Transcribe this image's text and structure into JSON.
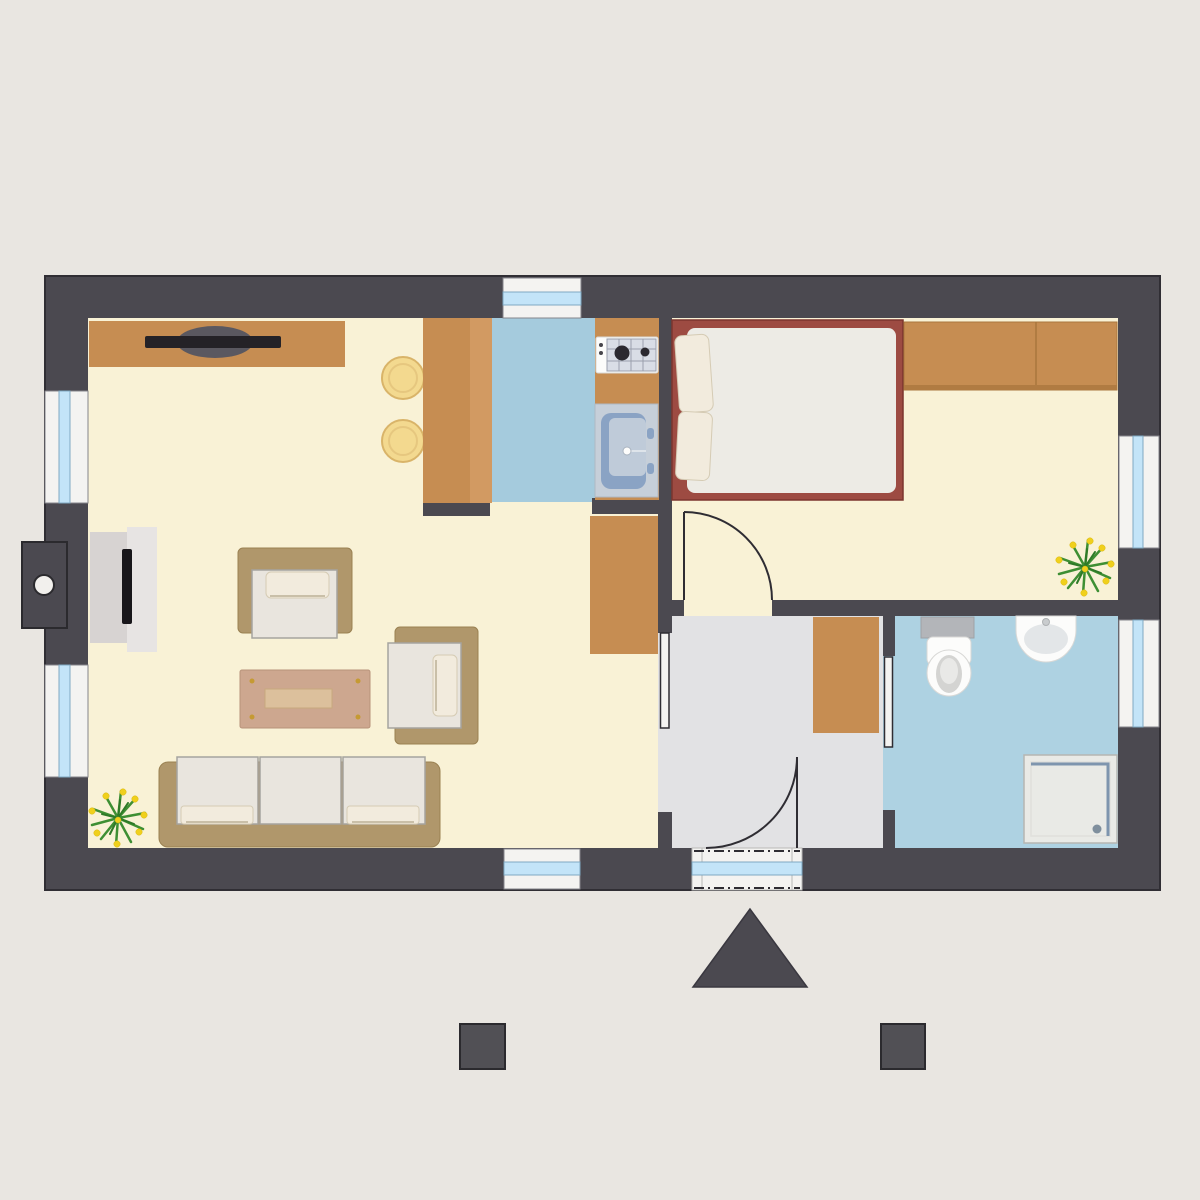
{
  "title": "apartment-floor-plan",
  "colors": {
    "bg": "#e9e6e1",
    "wall": "#4b4950",
    "wall-line": "#302e34",
    "floor-cream": "#f9f2d6",
    "floor-kitchen": "#a5cbdd",
    "floor-bath": "#aed2e2",
    "floor-hall": "#e2e2e4",
    "wood": "#c68d52",
    "wood-light": "#d29a62",
    "wood-edge": "#a9763d",
    "tan": "#b0976b",
    "tan-edge": "#9a8152",
    "cushion": "#e9e5de",
    "cushion-edge": "#a6a49f",
    "pillow": "#f2ebdd",
    "pillow-edge": "#d5cbb4",
    "bed-frame": "#9d4b42",
    "bed-edge": "#7c352e",
    "mattress": "#edebe5",
    "window-white": "#f4f3f1",
    "window-frame": "#85848a",
    "glass": "#c3e4f8",
    "glass-edge": "#7fa9c2",
    "tv-gray": "#d7d3d2",
    "tv-gray2": "#e7e4e3",
    "black": "#18161a",
    "table": "#cda78f",
    "table-edge": "#b8937a",
    "tray": "#dcc09c",
    "stool": "#f3d98f",
    "stool-edge": "#d9b469",
    "green": "#3e8f33",
    "green-dark": "#2e7a27",
    "flower": "#f0d01c",
    "steel": "#b3b5b9",
    "fixture": "#fcfcfb",
    "fixture-gray": "#d4d4d2",
    "sink-panel": "#c6cfd9",
    "basin": "#8aa3c4",
    "basin-light": "#bfcbd9",
    "cooktop": "#d9dde6",
    "cooktop-line": "#9aa0ad",
    "burner": "#2b2930",
    "shower": "#e9eae6",
    "shower-edge": "#b5b6b2",
    "shower-line": "#7e95ae",
    "door-line": "#2f2d33"
  },
  "plan": {
    "rooms": [
      {
        "id": "living-room",
        "floor_color": "#f9f2d6",
        "items": [
          "sideboard",
          "speaker",
          "soundbar",
          "bar-stool",
          "bar-stool",
          "tv-lowboard",
          "tv",
          "armchair",
          "armchair",
          "coffee-table",
          "sofa",
          "potted-plant",
          "side-cabinet"
        ]
      },
      {
        "id": "kitchen",
        "floor_color": "#a5cbdd",
        "items": [
          "bar-counter",
          "kitchen-counter",
          "cooktop",
          "kitchen-sink"
        ]
      },
      {
        "id": "bedroom",
        "floor_color": "#f9f2d6",
        "items": [
          "double-bed",
          "pillow",
          "pillow",
          "wardrobe",
          "potted-plant"
        ]
      },
      {
        "id": "hallway",
        "floor_color": "#e2e2e4",
        "items": [
          "cabinet"
        ]
      },
      {
        "id": "bathroom",
        "floor_color": "#aed2e2",
        "items": [
          "toilet",
          "washbasin",
          "shower"
        ]
      }
    ],
    "openings": {
      "windows": [
        {
          "id": "window-left-upper",
          "wall": "left"
        },
        {
          "id": "window-left-lower",
          "wall": "left"
        },
        {
          "id": "window-top-kitchen",
          "wall": "top"
        },
        {
          "id": "window-bottom-living",
          "wall": "bottom"
        },
        {
          "id": "window-right-bedroom",
          "wall": "right"
        },
        {
          "id": "window-right-bathroom",
          "wall": "right"
        }
      ],
      "doors": [
        {
          "id": "entrance-door",
          "type": "hinged",
          "swing": "into-hallway",
          "glazing": true
        },
        {
          "id": "bedroom-door",
          "type": "hinged",
          "swing": "into-bedroom"
        },
        {
          "id": "living-room-sliding-door",
          "type": "sliding"
        },
        {
          "id": "bathroom-sliding-door",
          "type": "sliding"
        }
      ]
    },
    "exterior_symbols": [
      "chimney",
      "entrance-marker-triangle",
      "porch-post-left",
      "porch-post-right"
    ]
  }
}
